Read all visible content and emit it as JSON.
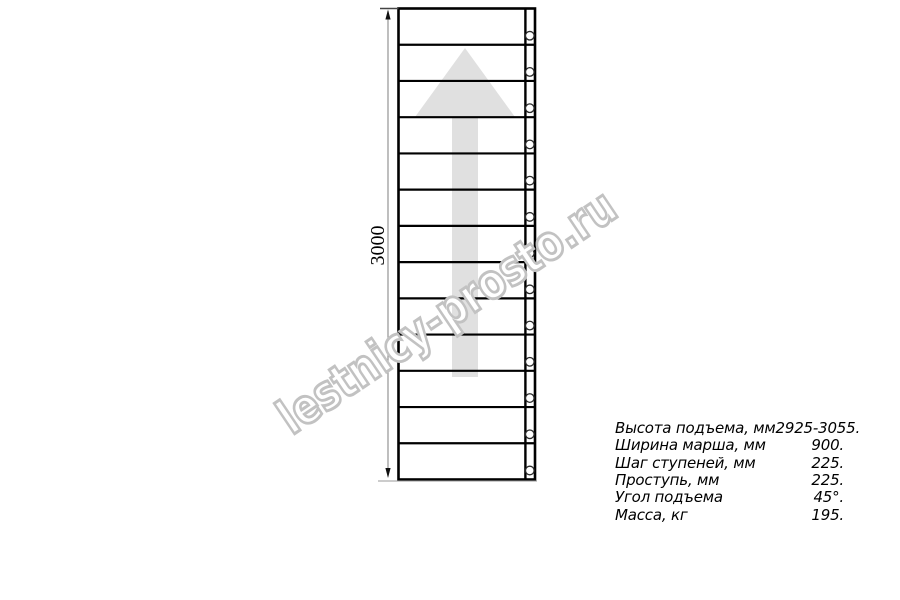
{
  "drawing": {
    "dimension_label": "3000",
    "steps": 13,
    "colors": {
      "line": "#000000",
      "arrow": "#e0e0e0",
      "dimension_line": "#8a8a8a",
      "extension_line": "#9a9a9a",
      "arrowhead": "#111111",
      "hole_stroke": "#2a2a2a"
    }
  },
  "watermark": {
    "text": "lestnicy-prosto.ru",
    "outline_color": "#c2c2c2"
  },
  "specs": {
    "rows": [
      {
        "label": "Высота подъема, мм",
        "value": "2925-3055."
      },
      {
        "label": "Ширина марша, мм",
        "value": "900."
      },
      {
        "label": "Шаг ступеней, мм",
        "value": "225."
      },
      {
        "label": "Проступь, мм",
        "value": "225."
      },
      {
        "label": "Угол подъема",
        "value": "45°."
      },
      {
        "label": "Масса, кг",
        "value": "195."
      }
    ]
  }
}
